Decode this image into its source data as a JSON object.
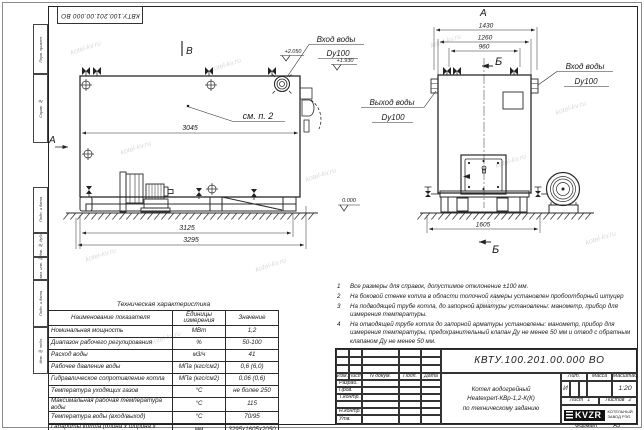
{
  "frame": {
    "top_stamp": "КВТУ.100.201.00.000 ВО",
    "side_labels": [
      "Перв. примен.",
      "Справ. №",
      "Подп. и дата",
      "Инв. № дубл.",
      "Взам. инв. №",
      "Подп. и дата",
      "Инв. № подл."
    ],
    "format_label": "Формат",
    "format_value": "А3"
  },
  "watermark": {
    "text": "kotel-kv.ru"
  },
  "drawing": {
    "view_a_label": "А",
    "view_b_label": "В",
    "section_b_label": "Б",
    "callout": "см. п. 2",
    "inlet_label": "Вход воды",
    "inlet_dn": "Dy100",
    "outlet_label": "Выход воды",
    "outlet_dn": "Dy100",
    "elev_inlet": "+2.050",
    "elev_inlet2": "+1.930",
    "elev_zero": "0.000",
    "dims": {
      "side_top": "3045",
      "side_frame": "3125",
      "side_overall": "3295",
      "front_w1": "1430",
      "front_w2": "1260",
      "front_w3": "960",
      "front_base": "1605"
    }
  },
  "tech_table": {
    "title": "Техническая характеристика",
    "headers": [
      "Наименование показателя",
      "Единицы измерения",
      "Значение"
    ],
    "rows": [
      [
        "Номинальная мощность",
        "МВт",
        "1,2"
      ],
      [
        "Диапазон рабочего регулирования",
        "%",
        "50-100"
      ],
      [
        "Расход воды",
        "м3/ч",
        "41"
      ],
      [
        "Рабочее давление воды",
        "МПа (кгс/см2)",
        "0,6 (6,0)"
      ],
      [
        "Гидравлическое сопротивление котла",
        "МПа (кгс/см2)",
        "0,06 (0,6)"
      ],
      [
        "Температура уходящих газов",
        "°С",
        "не более 250"
      ],
      [
        "Максимальная рабочая температура воды",
        "°С",
        "115"
      ],
      [
        "Температура воды (вход/выход)",
        "°С",
        "70/95"
      ],
      [
        "Габариты котла (длина х ширина х высота)",
        "мм",
        "3295х1605х2050"
      ]
    ]
  },
  "notes": [
    {
      "n": "1",
      "text": "Все размеры для справок, допустимое отклонение ±100 мм."
    },
    {
      "n": "2",
      "text": "На боковой стенке котла в области топочной камеры установлен пробоотборный штуцер"
    },
    {
      "n": "3",
      "text": "На  подводящей трубе котла, до запорной арматуры установлены: манометр, прибор для измерения температуры."
    },
    {
      "n": "4",
      "text": "На отводящей трубе котла до запорной арматуры установлены: манометр, прибор для измерения температуры, предохранительный клапан Ду не менее 50 мм и отвод с обратным клапаном Ду не менее 50 мм."
    }
  ],
  "title_block": {
    "doc_number": "КВТУ.100.201.00.000 ВО",
    "doc_name_lines": [
      "Котел водогрейный",
      "Heatexpert-КВр-1,2-К(К)",
      "по техническому заданию"
    ],
    "header_cols": [
      "Изм.",
      "Лист",
      "N докум.",
      "Подп.",
      "Дата"
    ],
    "row_labels": [
      "Разраб.",
      "Пров.",
      "Т.контр.",
      "",
      "Н.контр.",
      "Утв."
    ],
    "lit_label": "Лит.",
    "lit_value": "И",
    "mass_label": "Масса",
    "scale_label": "Масштаб",
    "scale_value": "1:20",
    "sheet_label": "Лист",
    "sheet_value": "1",
    "sheets_label": "Листов",
    "sheets_value": "2",
    "logo": "KVZR",
    "company_lines": [
      "КОТЕЛЬНЫЙ",
      "ЗАВОД РЭП"
    ]
  }
}
